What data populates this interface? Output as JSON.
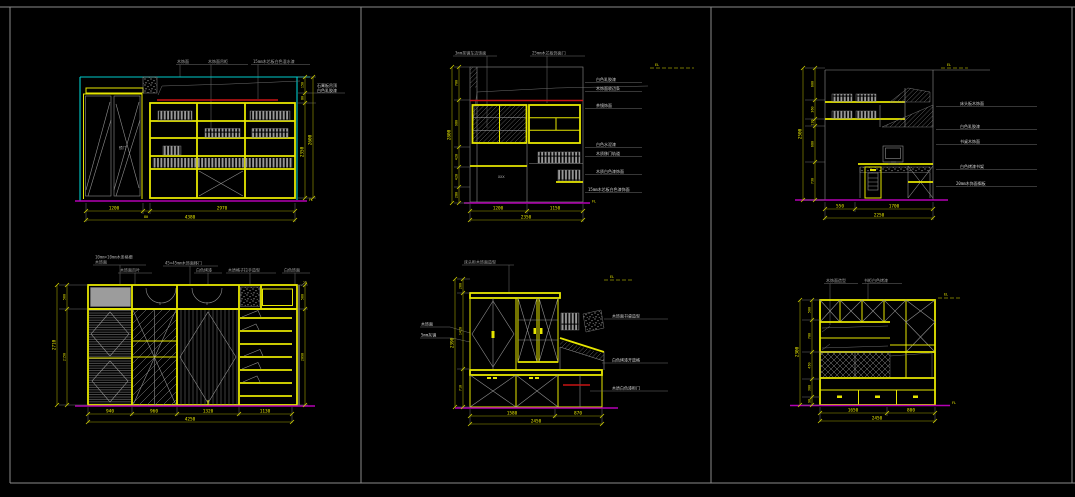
{
  "window": {
    "background": "#000000",
    "frame_color": "#8a8a8a"
  },
  "colors": {
    "cad_yellow": "#e6e600",
    "cad_cyan": "#00cccc",
    "cad_magenta": "#b400b4",
    "cad_red": "#c81414",
    "cad_gray": "#8f8f8f",
    "cad_white": "#d4d4d4"
  },
  "marks": {
    "level": "EL",
    "floor": "FL",
    "offset": "20"
  },
  "panels": {
    "p1": {
      "top_labels": [
        "木饰面",
        "木饰面吊柜",
        "15mm木芯板白色混水漆"
      ],
      "note": [
        "石膏板吊顶",
        "白色乳胶漆"
      ],
      "door": "镜门",
      "dim_b": [
        "1200",
        "80",
        "2970"
      ],
      "dim_b_all": "4380",
      "dim_r_top": [
        "150",
        "80"
      ],
      "dim_r": [
        "2350",
        "2600"
      ]
    },
    "p2": {
      "top_labels": [
        "3mm茶镜车边饰面",
        "25mm木芯板饰面门"
      ],
      "right_labels": [
        "白色乳胶漆",
        "木饰面收边条",
        "茶镜饰面",
        "白色水泥漆",
        "木质移门轨道",
        "木质白色漆饰面",
        "15mm木芯板白色漆饰面"
      ],
      "xxx": "XXX",
      "dim_l": [
        "700",
        "980",
        "420",
        "420",
        "280"
      ],
      "dim_l_all": "2800",
      "dim_b": [
        "1200",
        "1150"
      ],
      "dim_b_all": "2350"
    },
    "p3": {
      "right_labels": [
        "床头板木饰面",
        "白色乳胶漆",
        "书桌木饰面",
        "白色烤漆书架",
        "20mm木饰面搁板"
      ],
      "dim_l": [
        "600",
        "360",
        "130",
        "680",
        "730"
      ],
      "dim_l_all": "2500",
      "dim_b": [
        "550",
        "1700"
      ],
      "dim_b_all": "2250"
    },
    "p4": {
      "top_label_1a": "10mm×10mm木条格栅",
      "top_label_1b": "木饰面",
      "labels": [
        "木饰面百叶",
        "45×45mm木饰面移门",
        "白色烤漆",
        "木质格子拉手造型",
        "白色饰面"
      ],
      "dim_l": [
        "560",
        "2150"
      ],
      "dim_l_all": "2710",
      "dim_r": [
        "560",
        "2090"
      ],
      "dim_b": [
        "940",
        "960",
        "1320",
        "1130"
      ],
      "dim_b_all": "4250"
    },
    "p5": {
      "top_label": "床头柜木饰面造型",
      "left_labels": [
        "木饰面",
        "5mm灰镜"
      ],
      "right_labels": [
        "木饰面书桌造型",
        "白色烤漆开放格",
        "木质白色漆柜门"
      ],
      "dim_l": [
        "260",
        "1420",
        "710"
      ],
      "dim_l_all": "2390",
      "dim_b": [
        "1580",
        "870"
      ],
      "dim_b_all": "2450"
    },
    "p6": {
      "top_labels": [
        "木饰面造型",
        "书柜白色烤漆"
      ],
      "dim_l": [
        "500",
        "700",
        "450",
        "300",
        "90"
      ],
      "dim_l_all": "2300",
      "dim_b": [
        "1650",
        "800"
      ],
      "dim_b_all": "2450"
    }
  }
}
